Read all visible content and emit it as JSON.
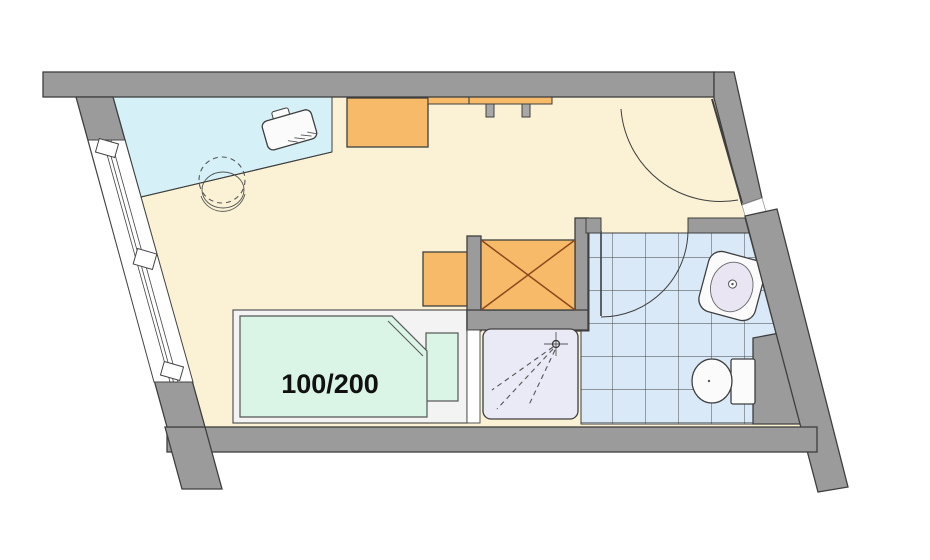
{
  "diagram": {
    "type": "architectural-floor-plan",
    "description": "studio room with window, desk area, bed, wardrobe niche and tiled bathroom",
    "bed": {
      "size_label": "100/200"
    },
    "colors": {
      "wall": "#9b9b9b",
      "outline": "#3f3f3f",
      "floor": "#fbf2d5",
      "desk_surface": "#d5f1f7",
      "furniture_orange": "#f6ba69",
      "wardrobe_cross": "#8a4a1d",
      "mattress_green": "#daf4e6",
      "bed_frame": "#f3f3f3",
      "tile_blue": "#d9e9f7",
      "shower_tray": "#eaeaf6",
      "fixture_white": "#fbfbfb",
      "sink_basin": "#e9e5f3",
      "window_white": "#ffffff",
      "shelf_leg_gray": "#a8a8a8"
    }
  }
}
